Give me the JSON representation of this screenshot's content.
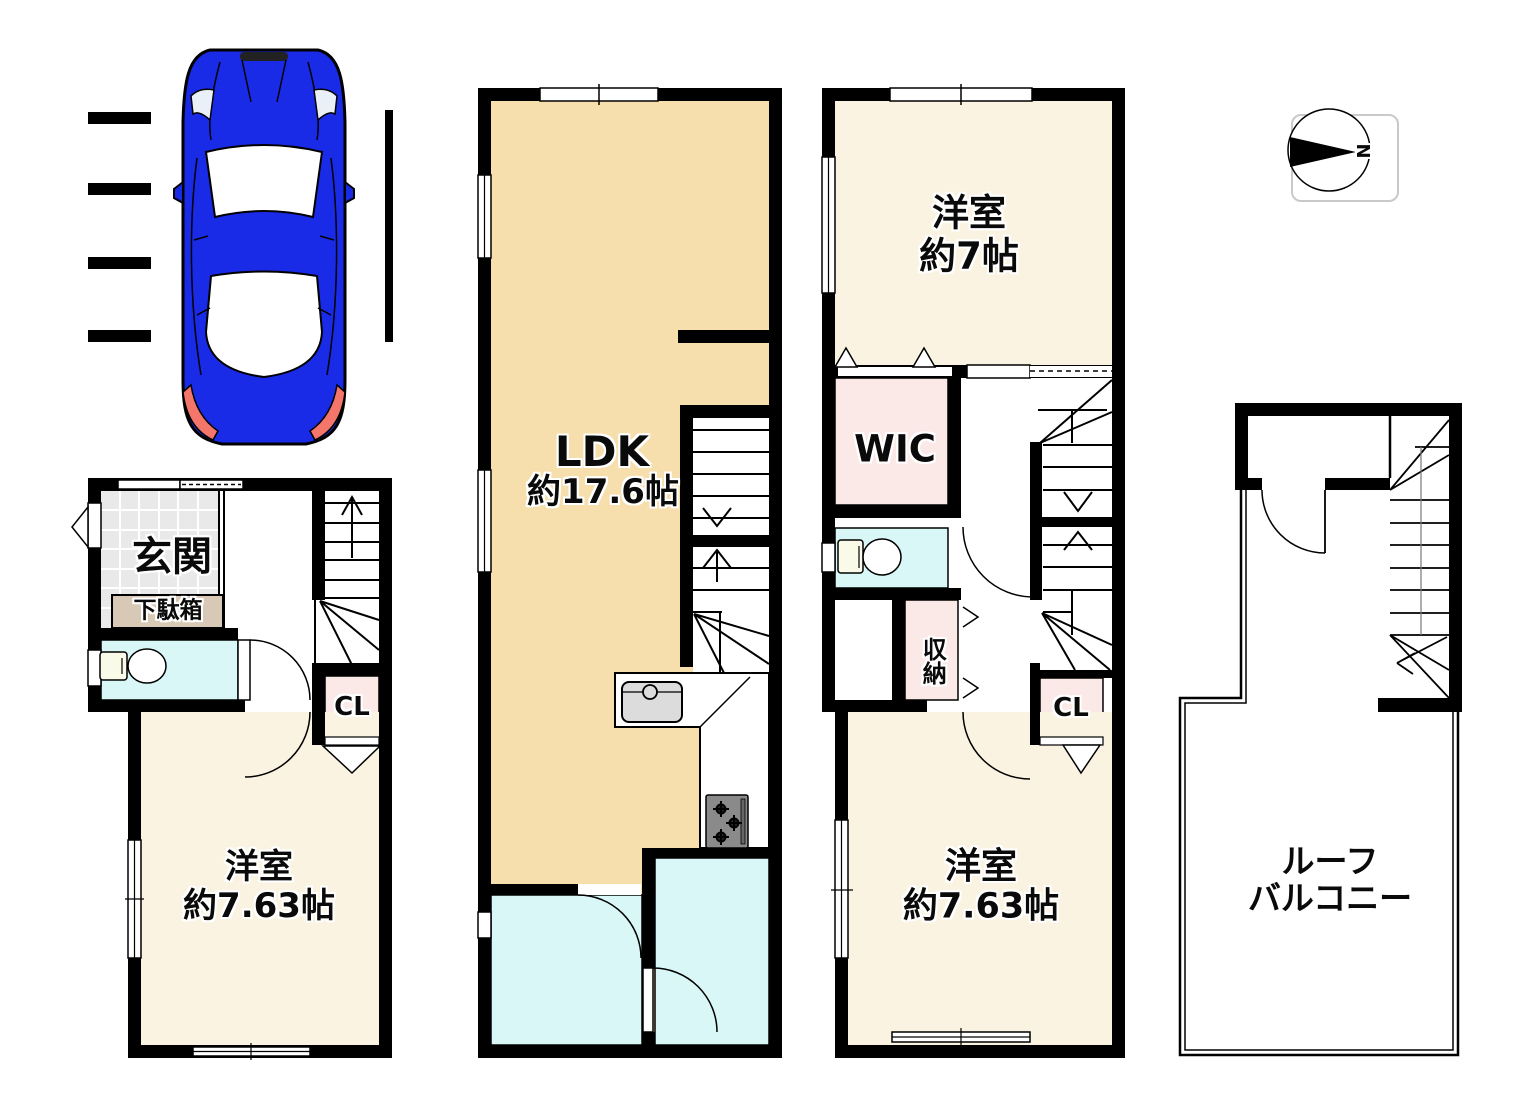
{
  "floor1": {
    "entrance": "玄関",
    "shoe_cabinet": "下駄箱",
    "closet": "CL",
    "bedroom": "洋室",
    "bedroom_size": "約7.63帖"
  },
  "floor2": {
    "ldk": "LDK",
    "ldk_size": "約17.6帖"
  },
  "floor3": {
    "bedroom_top": "洋室",
    "bedroom_top_size": "約7帖",
    "walk_in_closet": "WIC",
    "storage": "収納",
    "closet": "CL",
    "bedroom_bottom": "洋室",
    "bedroom_bottom_size": "約7.63帖"
  },
  "roof": {
    "balcony_line1": "ルーフ",
    "balcony_line2": "バルコニー"
  },
  "compass": {
    "north": "N"
  },
  "colors": {
    "wall": "#000000",
    "ldk_floor": "#F6DFAD",
    "bedroom_floor": "#FAF3E2",
    "wet_area": "#D9F7F7",
    "closet_pink": "#FBE9E8",
    "entrance_tile": "#E9E9E9",
    "shoe_cabinet": "#D8C8B6",
    "stove": "#8A8A8A",
    "car_body": "#1A2BE8",
    "taillight": "#F4766B"
  }
}
